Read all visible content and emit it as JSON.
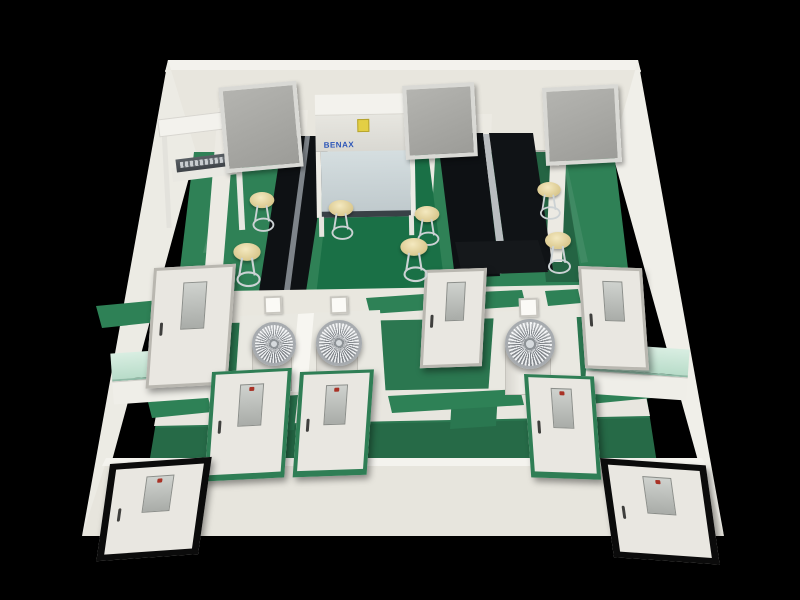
{
  "meta": {
    "description": "3D cutaway rendering of a laboratory floor plan viewed from above, green epoxy floors, white walls, black island benches, on a black background",
    "canvas": {
      "w": 800,
      "h": 600
    }
  },
  "palette": {
    "background": "#000000",
    "wall": "#e8e6de",
    "floor_green": "#2f8156",
    "floor_green_dark": "#2b7750",
    "bench_black": "#0e1114",
    "stool_tan": "#dac88e",
    "counter_teal": "#c9e6da",
    "turbine_silver": "#b9bdc0",
    "door_frame_green": "#2f7e55",
    "door_frame_gray": "#b9b7b0",
    "door_frame_black": "#0b0b0b",
    "cabinet_label_blue": "#2b55b8",
    "cabinet_sticker_yellow": "#e3cf44"
  },
  "equipment": {
    "biosafety_cabinet": {
      "brand_label": "BENAX"
    },
    "turbine_unit_count": 3,
    "stool_count": 7,
    "window_count": 3,
    "door_count": 8
  },
  "polygons": [
    {
      "name": "back-wall-top",
      "fill": "#f3f2ed",
      "pts": "168,60 638,60 641,72 165,72"
    },
    {
      "name": "back-wall-face",
      "fill": "#e8e6de",
      "pts": "165,70 641,70 614,152 194,152"
    },
    {
      "name": "left-wall",
      "fill": "#ecebe4",
      "pts": "168,60 196,152 110,468 82,536"
    },
    {
      "name": "right-wall",
      "fill": "#f0efe9",
      "pts": "638,60 612,152 700,468 724,536"
    },
    {
      "name": "floor-upper",
      "fill": "#2f8156",
      "pts": "194,152 614,152 632,302 176,302"
    },
    {
      "name": "floor-mid",
      "fill": "#2b7750",
      "pts": "176,302 632,302 658,470 148,470"
    },
    {
      "name": "floor-streak-1",
      "fill": "rgba(255,255,255,0.10)",
      "pts": "225,165 232,164 210,252 203,253"
    },
    {
      "name": "floor-streak-2",
      "fill": "rgba(255,255,255,0.08)",
      "pts": "560,160 566,160 588,262 581,263"
    },
    {
      "name": "floor-streak-3",
      "fill": "rgba(255,255,255,0.08)",
      "pts": "350,300 470,296 474,306 352,310"
    },
    {
      "name": "floor-shadow-right",
      "fill": "rgba(0,0,0,0.22)",
      "pts": "533,150 562,150 582,282 546,282"
    },
    {
      "name": "floor-shadow-left",
      "fill": "rgba(0,0,0,0.18)",
      "pts": "256,298 332,294 342,332 248,336"
    },
    {
      "name": "divider-wall-a",
      "fill": "#eceae3",
      "pts": "218,108 236,108 222,280 204,280"
    },
    {
      "name": "divider-wall-b",
      "fill": "#eceae3",
      "pts": "290,110 308,110 296,278 280,278"
    },
    {
      "name": "divider-wall-c",
      "fill": "#eceae3",
      "pts": "420,110 438,110 428,278 412,278"
    },
    {
      "name": "divider-wall-d",
      "fill": "#eceae3",
      "pts": "474,114 492,114 486,272 468,272"
    },
    {
      "name": "divider-wall-e",
      "fill": "#eceae3",
      "pts": "552,116 568,116 562,262 546,262"
    },
    {
      "name": "center-table-rim",
      "fill": "#cdd6d3",
      "pts": "331,146 430,146 432,158 329,158"
    },
    {
      "name": "center-table",
      "fill": "#1a7046",
      "pts": "333,152 428,152 446,296 316,296"
    },
    {
      "name": "island-bench-left",
      "fill": "#0e1114",
      "pts": "283,136 330,136 305,298 258,298"
    },
    {
      "name": "island-bench-left-gap",
      "fill": "#7e848a",
      "pts": "305,136 310,136 289,298 283,298"
    },
    {
      "name": "island-bench-right-1",
      "fill": "#0e1114",
      "pts": "437,133 483,133 500,276 455,278"
    },
    {
      "name": "island-bench-gap",
      "fill": "#b9bdc0",
      "pts": "483,134 489,134 508,272 500,274"
    },
    {
      "name": "island-bench-right-2",
      "fill": "#101316",
      "pts": "489,133 533,133 553,270 508,272"
    },
    {
      "name": "bench-end-table",
      "fill": "#15181b",
      "pts": "455,242 538,240 548,272 462,275"
    },
    {
      "name": "mid-wall-band",
      "fill": "#e9e7df",
      "pts": "170,292 632,284 638,316 164,324"
    },
    {
      "name": "benchtop-strip-left",
      "fill": "#2e8156",
      "pts": "96,306 170,299 176,320 102,328"
    },
    {
      "name": "benchtop-strip-c1",
      "fill": "#2e8156",
      "pts": "366,298 424,294 428,310 370,314"
    },
    {
      "name": "benchtop-strip-c2",
      "fill": "#2e8156",
      "pts": "478,292 522,290 526,306 482,309"
    },
    {
      "name": "benchtop-strip-right",
      "fill": "#2e8156",
      "pts": "545,291 578,289 581,303 548,306"
    },
    {
      "name": "turbine-room-left",
      "fill": "#e9e8e1",
      "pts": "240,316 380,310 386,398 234,404"
    },
    {
      "name": "turbine-room-divider",
      "fill": "#f7f6f1",
      "pts": "298,314 314,313 306,401 290,402"
    },
    {
      "name": "turbine-room-right",
      "fill": "#e9e8e1",
      "pts": "494,312 576,308 582,392 488,396"
    },
    {
      "name": "corridor-shade",
      "fill": "rgba(0,0,0,0.10)",
      "pts": "148,428 652,418 658,462 142,468"
    },
    {
      "name": "lower-wall-band",
      "fill": "#e8e6df",
      "pts": "160,394 644,386 650,416 154,426"
    },
    {
      "name": "floor-connector-1",
      "fill": "#2a7750",
      "pts": "252,398 298,395 294,430 248,433"
    },
    {
      "name": "floor-connector-2",
      "fill": "#2a7750",
      "pts": "452,394 498,391 496,426 450,429"
    },
    {
      "name": "benchtop-strip-l2",
      "fill": "#2e8156",
      "pts": "148,402 208,397 212,412 152,418"
    },
    {
      "name": "benchtop-strip-c3",
      "fill": "#2e8156",
      "pts": "388,396 520,389 524,405 392,413"
    },
    {
      "name": "benchtop-strip-r2",
      "fill": "#2e8156",
      "pts": "586,387 648,382 652,398 590,404"
    },
    {
      "name": "bottom-wall-face",
      "fill": "#e7e5dd",
      "pts": "106,462 702,462 724,536 82,536"
    },
    {
      "name": "bottom-wall-top",
      "fill": "#f4f3ee",
      "pts": "106,458 702,458 706,466 102,466"
    }
  ],
  "windows": [
    {
      "name": "back-window-left",
      "x": 222,
      "y": 84,
      "w": 70,
      "h": 78,
      "rot": -5
    },
    {
      "name": "back-window-middle",
      "x": 404,
      "y": 84,
      "w": 64,
      "h": 66,
      "rot": -3
    },
    {
      "name": "back-window-right",
      "x": 544,
      "y": 86,
      "w": 68,
      "h": 70,
      "rot": -3
    }
  ],
  "doors": [
    {
      "name": "door-mid-left",
      "type": "gray",
      "x": 154,
      "y": 268,
      "w": 76,
      "h": 114,
      "rot": -3,
      "skx": -7
    },
    {
      "name": "door-mid-center",
      "type": "gray",
      "x": 425,
      "y": 270,
      "w": 56,
      "h": 92,
      "rot": -2,
      "skx": -5
    },
    {
      "name": "door-mid-right",
      "type": "gray",
      "x": 578,
      "y": 266,
      "w": 58,
      "h": 96,
      "rot": 2,
      "skx": 6
    },
    {
      "name": "door-lower-left-1",
      "type": "green",
      "x": 212,
      "y": 372,
      "w": 72,
      "h": 100,
      "rot": -3,
      "skx": -7
    },
    {
      "name": "door-lower-left-2",
      "type": "green",
      "x": 300,
      "y": 372,
      "w": 66,
      "h": 96,
      "rot": -2,
      "skx": -6
    },
    {
      "name": "door-lower-right",
      "type": "green",
      "x": 524,
      "y": 374,
      "w": 62,
      "h": 94,
      "rot": 2,
      "skx": 6
    },
    {
      "name": "door-entry-left",
      "type": "black",
      "x": 110,
      "y": 464,
      "w": 88,
      "h": 84,
      "rot": -4,
      "skx": -12
    },
    {
      "name": "door-entry-right",
      "type": "black",
      "x": 600,
      "y": 458,
      "w": 92,
      "h": 86,
      "rot": 4,
      "skx": 12
    }
  ],
  "stools": [
    {
      "x": 262,
      "y": 199,
      "s": 0.95
    },
    {
      "x": 247,
      "y": 252,
      "s": 1.05
    },
    {
      "x": 341,
      "y": 207,
      "s": 0.95
    },
    {
      "x": 427,
      "y": 213,
      "s": 0.95
    },
    {
      "x": 414,
      "y": 247,
      "s": 1.05
    },
    {
      "x": 549,
      "y": 188,
      "s": 0.9
    },
    {
      "x": 558,
      "y": 240,
      "s": 1.0
    }
  ],
  "turbines": [
    {
      "name": "turbine-unit-1",
      "x": 271,
      "y": 341,
      "d": 38,
      "pw": 38,
      "ph": 42
    },
    {
      "name": "turbine-unit-2",
      "x": 336,
      "y": 340,
      "d": 40,
      "pw": 40,
      "ph": 44
    },
    {
      "name": "turbine-unit-3",
      "x": 527,
      "y": 341,
      "d": 44,
      "pw": 44,
      "ph": 46
    }
  ],
  "counters": [
    {
      "name": "teal-counter-left",
      "x": 112,
      "y": 350,
      "w": 102,
      "rot": -4
    },
    {
      "name": "teal-counter-right",
      "x": 586,
      "y": 346,
      "w": 102,
      "rot": 4
    }
  ],
  "switch_panels": [
    {
      "x": 264,
      "y": 296,
      "s": 14
    },
    {
      "x": 330,
      "y": 296,
      "s": 14
    },
    {
      "x": 519,
      "y": 298,
      "s": 15
    }
  ]
}
